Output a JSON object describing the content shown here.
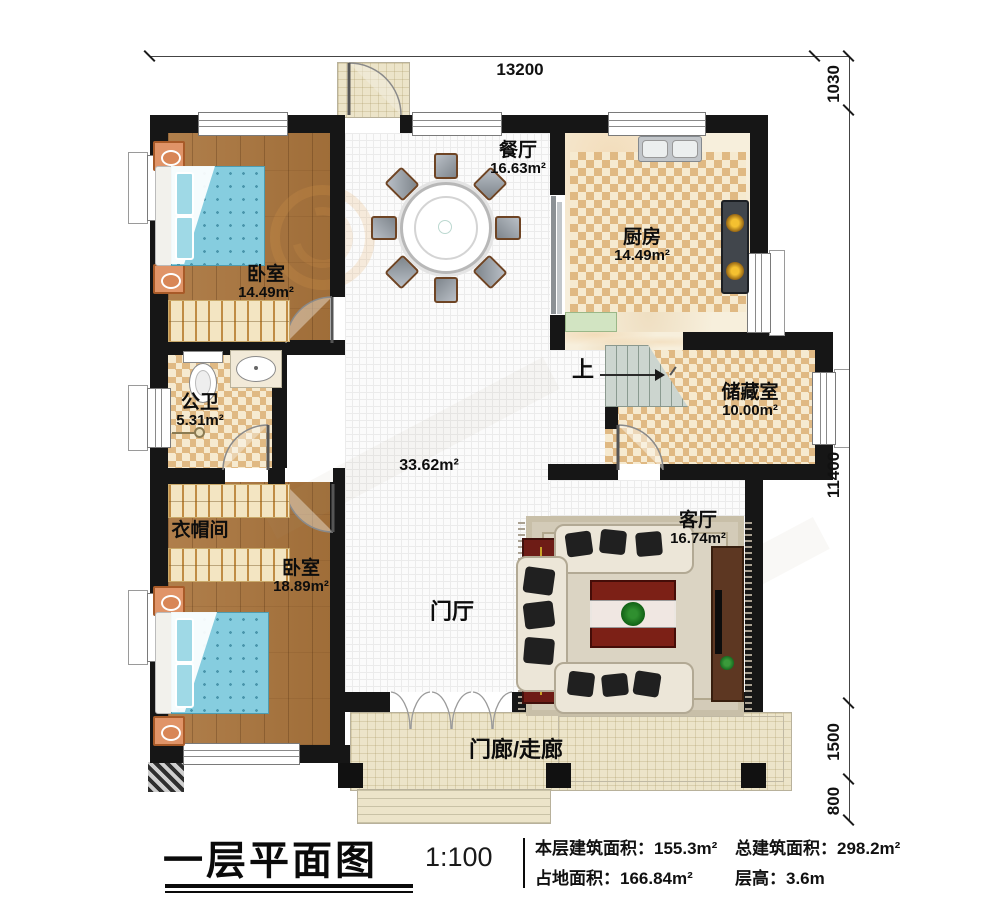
{
  "plan": {
    "title": "一层平面图",
    "scale": "1:100",
    "stats": {
      "floor_area_label": "本层建筑面积：",
      "floor_area_value": "155.3m²",
      "total_area_label": "总建筑面积：",
      "total_area_value": "298.2m²",
      "land_area_label": "占地面积：",
      "land_area_value": "166.84m²",
      "height_label": "层高：",
      "height_value": "3.6m"
    },
    "dimensions": {
      "top_width": "13200",
      "right_top": "1030",
      "right_main": "11400",
      "right_porch": "1500",
      "right_steps": "800"
    },
    "rooms": {
      "dining": {
        "name": "餐厅",
        "area": "16.63m²"
      },
      "kitchen": {
        "name": "厨房",
        "area": "14.49m²"
      },
      "bedroom_top": {
        "name": "卧室",
        "area": "14.49m²"
      },
      "bathroom": {
        "name": "公卫",
        "area": "5.31m²"
      },
      "storage": {
        "name": "储藏室",
        "area": "10.00m²"
      },
      "cloakroom": {
        "name": "衣帽间"
      },
      "bedroom_bottom": {
        "name": "卧室",
        "area": "18.89m²"
      },
      "living": {
        "name": "客厅",
        "area": "16.74m²"
      },
      "hall": {
        "name": "门厅",
        "area": "33.62m²"
      },
      "porch": {
        "name": "门廊/走廊"
      },
      "stairs": {
        "up": "上"
      }
    }
  }
}
